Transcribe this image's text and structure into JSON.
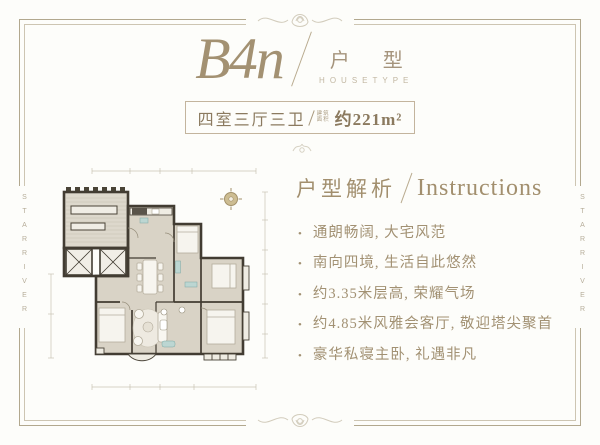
{
  "page": {
    "accent_color": "#a28f6e",
    "frame_color": "#b2a88e",
    "wall_color": "#423c32",
    "floor_color": "#d9d3c6"
  },
  "header": {
    "plan_code": "B4n",
    "unit_type_cn": "户 型",
    "unit_type_en": "HOUSETYPE"
  },
  "area_box": {
    "rooms": "四室三厅三卫",
    "area_prefix_line1": "建筑",
    "area_prefix_line2": "面积",
    "area_value": "约221m²"
  },
  "watermark": {
    "left": "STARRIVER",
    "right": "STARRIVER"
  },
  "analysis": {
    "heading_cn": "户型解析",
    "heading_en": "Instructions",
    "bullet_glyph": "•",
    "bullets": [
      "通朗畅阔, 大宅风范",
      "南向四境, 生活自此悠然",
      "约3.35米层高, 荣耀气场",
      "约4.85米风雅会客厅, 敬迎塔尖聚首",
      "豪华私寝主卧, 礼遇非凡"
    ]
  }
}
